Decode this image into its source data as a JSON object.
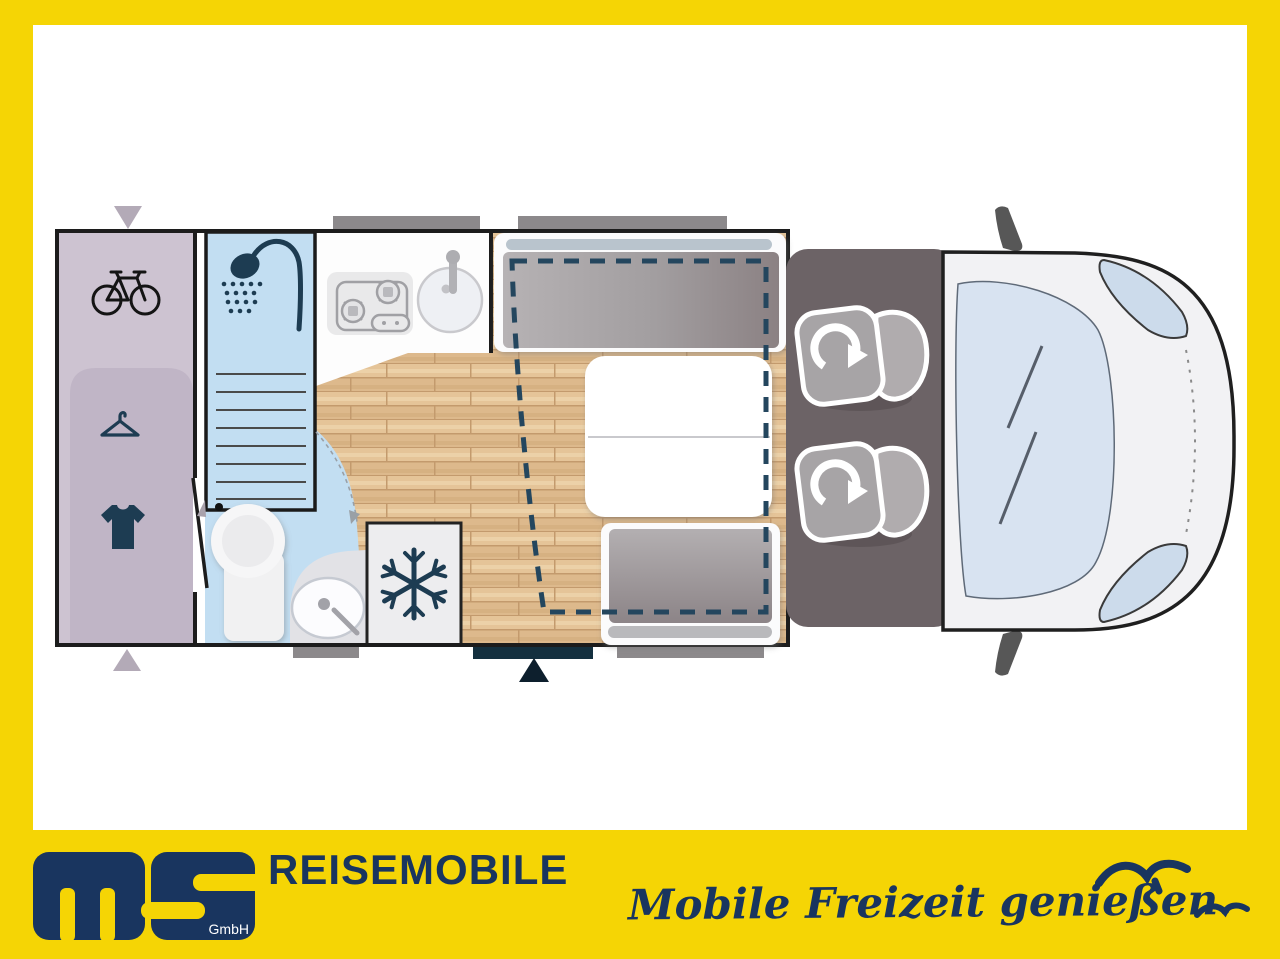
{
  "brand": {
    "logo_m": "m",
    "logo_s": "S",
    "logo_subtitle": "GmbH",
    "division": "REISEMOBILE",
    "slogan": "Mobile Freizeit genießen."
  },
  "palette": {
    "frame_yellow": "#f5d505",
    "brand_navy": "#19355f",
    "icon_navy": "#1d3c52",
    "garage_lavender": "#cdc3d1",
    "bathroom_blue": "#c2def2",
    "wood_floor": "#e3c195",
    "cushion_gray": "#a09ca0",
    "cab_gray": "#6c6366",
    "entry_step_navy": "#14303f",
    "dashed_bed_outline": "#24465e"
  },
  "floorplan": {
    "markers": {
      "rear_top_marker": "triangle-down",
      "rear_bottom_marker": "triangle-up",
      "entry_marker": "triangle-up"
    },
    "zones": [
      {
        "id": "rear-garage",
        "icons": [
          "bicycle-icon",
          "hanger-icon",
          "tshirt-icon"
        ]
      },
      {
        "id": "bathroom",
        "icons": [
          "shower-icon",
          "toilet",
          "washbasin"
        ]
      },
      {
        "id": "kitchen",
        "icons": [
          "stove-icon",
          "sink-icon"
        ]
      },
      {
        "id": "fridge",
        "icons": [
          "snowflake-icon"
        ]
      },
      {
        "id": "dinette",
        "features": [
          "front-bench-seat",
          "table",
          "rear-bench-seat",
          "drop-down-bed-outline"
        ]
      },
      {
        "id": "cab",
        "features": [
          "swivel-seat-left",
          "swivel-seat-right",
          "windshield",
          "side-mirrors",
          "headlights"
        ]
      }
    ]
  }
}
